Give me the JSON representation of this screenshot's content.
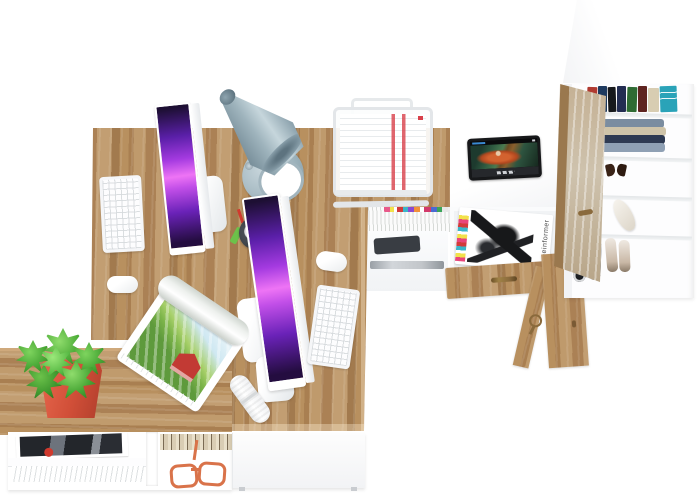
{
  "meta": {
    "type": "3D product render",
    "view": "top-down",
    "description": "Top-down render of a two-person oak and white home-office set: L-shaped double desk with two all-in-one computers, cone desk lamp, wire document tray, side table with tablet, open drawer with magazines, tall wardrobe with books, clothes and shoes, low storage cabinets and a potted plant"
  },
  "palette": {
    "background": "#ffffff",
    "oak_wood": "#b18a5d",
    "oak_wood_dark": "#a27a4e",
    "white_furniture": "#fdfdfe",
    "lamp_gray_blue": "#9fb4bd",
    "screen_violet": "#c24fe8",
    "plant_green": "#46a534",
    "pot_red": "#d14f38",
    "copper_accent": "#d9734a",
    "hardware_bronze": "#8a6a3c",
    "paper_stripe_red": "#d8404a"
  },
  "objects": {
    "desk": "L-shaped oak double workstation desk",
    "monitor_count": "2",
    "monitors": "white all-in-one monitors with violet galaxy wallpaper",
    "keyboards": "2 white keyboards",
    "mice": "2 white mice",
    "lamp": "gray-blue cone desk lamp",
    "document_tray": "white wire paper tray with printed documents",
    "tablet": "black tablet playing an animated movie",
    "plant": "green succulent in a red square pot",
    "magazine_roll": "rolled magazine with countryside cover",
    "pen_cup": "dark pen cup with pencils and markers",
    "remote": "white remote control",
    "drawer": "open drawer with magazines",
    "wardrobe": "tall white wardrobe with books, folded clothes and shoes",
    "wardrobe_door": "open weathered-oak wardrobe door",
    "storage": "white open storage cabinets with magazines, books and copper reading glasses"
  },
  "drawer_magazine": {
    "masthead": "gameinformer"
  },
  "wardrobe": {
    "book_colors": [
      "#b03a30",
      "#1e3a5f",
      "#17191c",
      "#232d52",
      "#2e6b33",
      "#5e2420",
      "#d8cdb2",
      "#2aa3b8"
    ]
  }
}
